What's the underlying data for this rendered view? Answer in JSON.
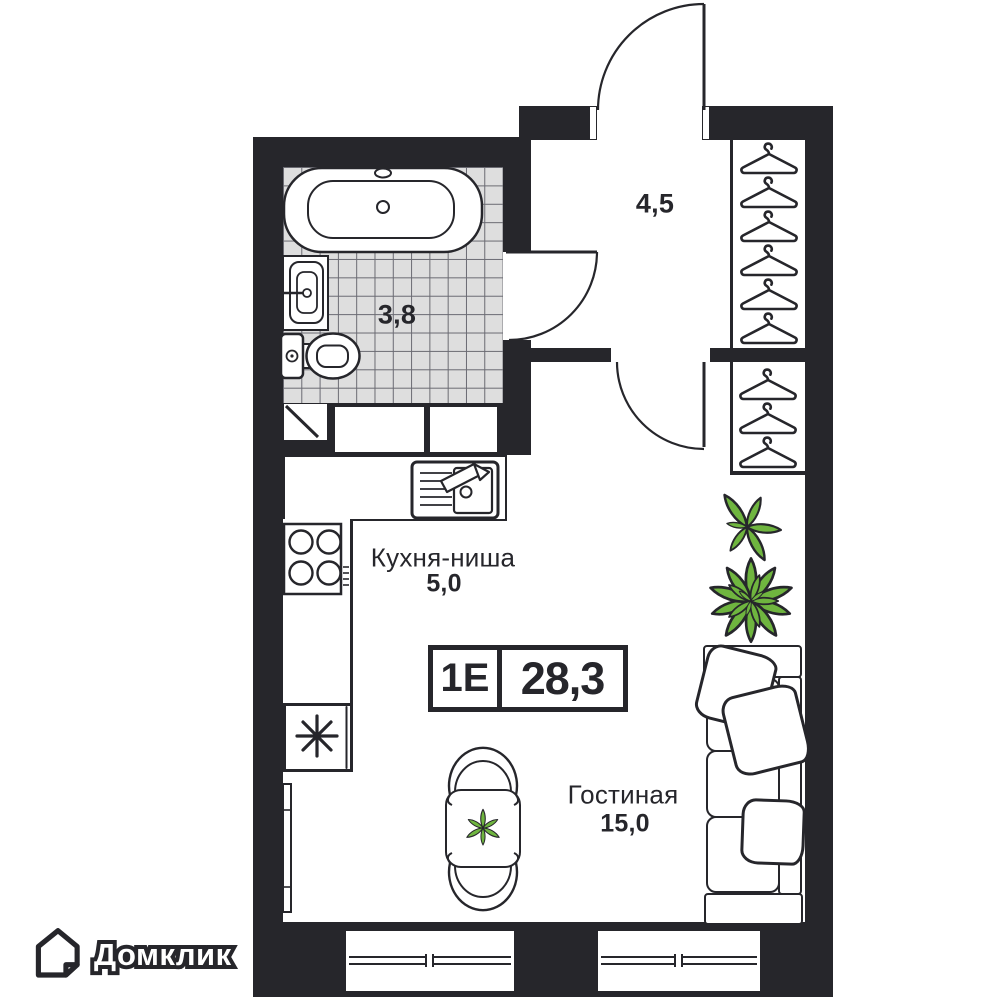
{
  "branding": {
    "logo_text": "Домклик"
  },
  "unit": {
    "type_label": "1Е",
    "total_area": "28,3"
  },
  "rooms": {
    "hallway": {
      "area": "4,5"
    },
    "bathroom": {
      "area": "3,8"
    },
    "kitchen": {
      "name": "Кухня-ниша",
      "area": "5,0"
    },
    "living": {
      "name": "Гостиная",
      "area": "15,0"
    }
  },
  "colors": {
    "wall": "#26262B",
    "tile_fill": "#DEDEDE",
    "tile_line": "#6A6A72",
    "plant_green": "#6FB53F",
    "background": "#FFFFFF"
  }
}
